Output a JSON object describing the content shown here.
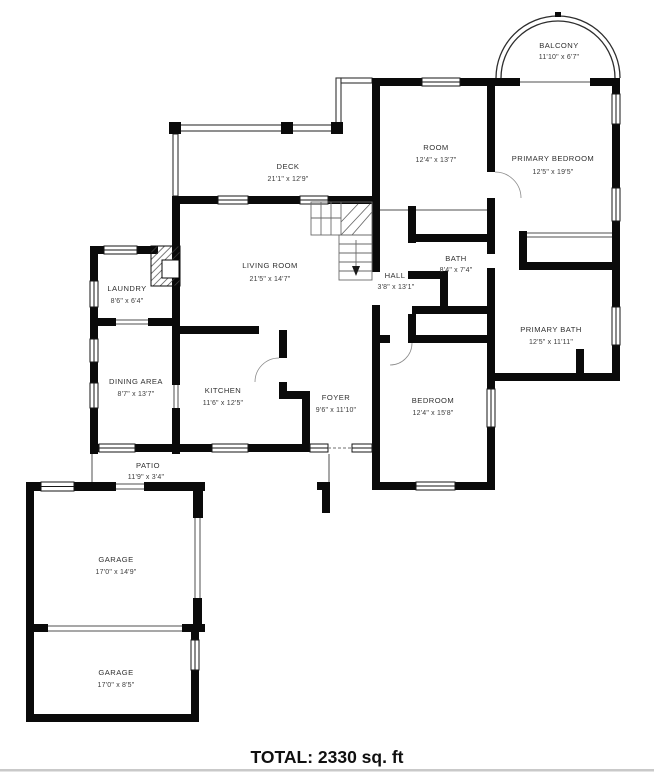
{
  "floor_plan": {
    "total_label": "TOTAL: 2330 sq. ft",
    "colors": {
      "wall": "#000000",
      "text": "#303030",
      "divider": "#c9c9c9"
    },
    "rooms": {
      "balcony": {
        "name": "BALCONY",
        "dims": "11'10\" x 6'7\""
      },
      "room": {
        "name": "ROOM",
        "dims": "12'4\" x 13'7\""
      },
      "primary_bedroom": {
        "name": "PRIMARY BEDROOM",
        "dims": "12'5\" x 19'5\""
      },
      "deck": {
        "name": "DECK",
        "dims": "21'1\" x 12'9\""
      },
      "living_room": {
        "name": "LIVING ROOM",
        "dims": "21'5\" x 14'7\""
      },
      "bath": {
        "name": "BATH",
        "dims": "8'4\" x 7'4\""
      },
      "hall": {
        "name": "HALL",
        "dims": "3'8\" x 13'1\""
      },
      "laundry": {
        "name": "LAUNDRY",
        "dims": "8'6\" x 6'4\""
      },
      "primary_bath": {
        "name": "PRIMARY BATH",
        "dims": "12'5\" x 11'11\""
      },
      "dining_area": {
        "name": "DINING AREA",
        "dims": "8'7\" x 13'7\""
      },
      "kitchen": {
        "name": "KITCHEN",
        "dims": "11'6\" x 12'5\""
      },
      "foyer": {
        "name": "FOYER",
        "dims": "9'6\" x 11'10\""
      },
      "bedroom": {
        "name": "BEDROOM",
        "dims": "12'4\" x 15'8\""
      },
      "patio": {
        "name": "PATIO",
        "dims": "11'9\" x 3'4\""
      },
      "garage_upper": {
        "name": "GARAGE",
        "dims": "17'0\" x 14'9\""
      },
      "garage_lower": {
        "name": "GARAGE",
        "dims": "17'0\" x 8'5\""
      }
    }
  }
}
